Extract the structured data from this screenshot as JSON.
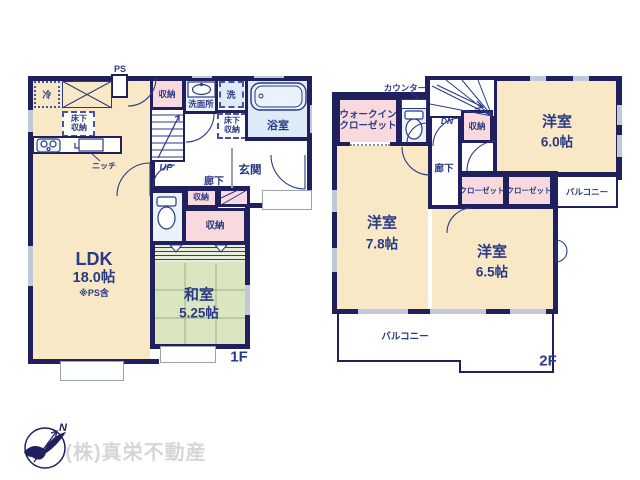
{
  "colors": {
    "wall": "#20205e",
    "ink": "#2b3a85",
    "cream": "#f8e8c5",
    "tatami": "#dae6bf",
    "pink": "#f8d9de",
    "aqua": "#dcebf7",
    "aqualight": "#eaf2fb",
    "gray": "#9aa3b5",
    "window": "#c2c9d6",
    "stripebg": "#e7eed9",
    "grid": "#a8b98c",
    "company": "#d6d6d6"
  },
  "floor1": {
    "floor_label": "1F",
    "ps_label": "PS",
    "fridge": "冷",
    "underfloor_storage_kitchen": "床下収納",
    "niche": "ニッチ",
    "storage_stairs": "収納",
    "washroom": "洗面所",
    "washer": "洗",
    "underfloor_storage_hall": "床下収納",
    "bathroom": "浴室",
    "up": "UP",
    "hallway": "廊下",
    "entrance": "玄関",
    "storage_small": "収納",
    "storage_hall": "収納",
    "ldk_name": "LDK",
    "ldk_size": "18.0帖",
    "ldk_note": "※PS含",
    "washitsu_name": "和室",
    "washitsu_size": "5.25帖"
  },
  "floor2": {
    "floor_label": "2F",
    "counter": "カウンター",
    "walk_in_closet": "ウォークインクローゼット",
    "dn": "DN",
    "storage": "収納",
    "bedroom_a_name": "洋室",
    "bedroom_a_size": "6.0帖",
    "hallway": "廊下",
    "closet_a": "クローゼット",
    "closet_b": "クローゼット",
    "balcony_side": "バルコニー",
    "bedroom_b_name": "洋室",
    "bedroom_b_size": "7.8帖",
    "bedroom_c_name": "洋室",
    "bedroom_c_size": "6.5帖",
    "balcony_main": "バルコニー"
  },
  "footer": {
    "company": "(株)真栄不動産",
    "compass_north": "N"
  }
}
